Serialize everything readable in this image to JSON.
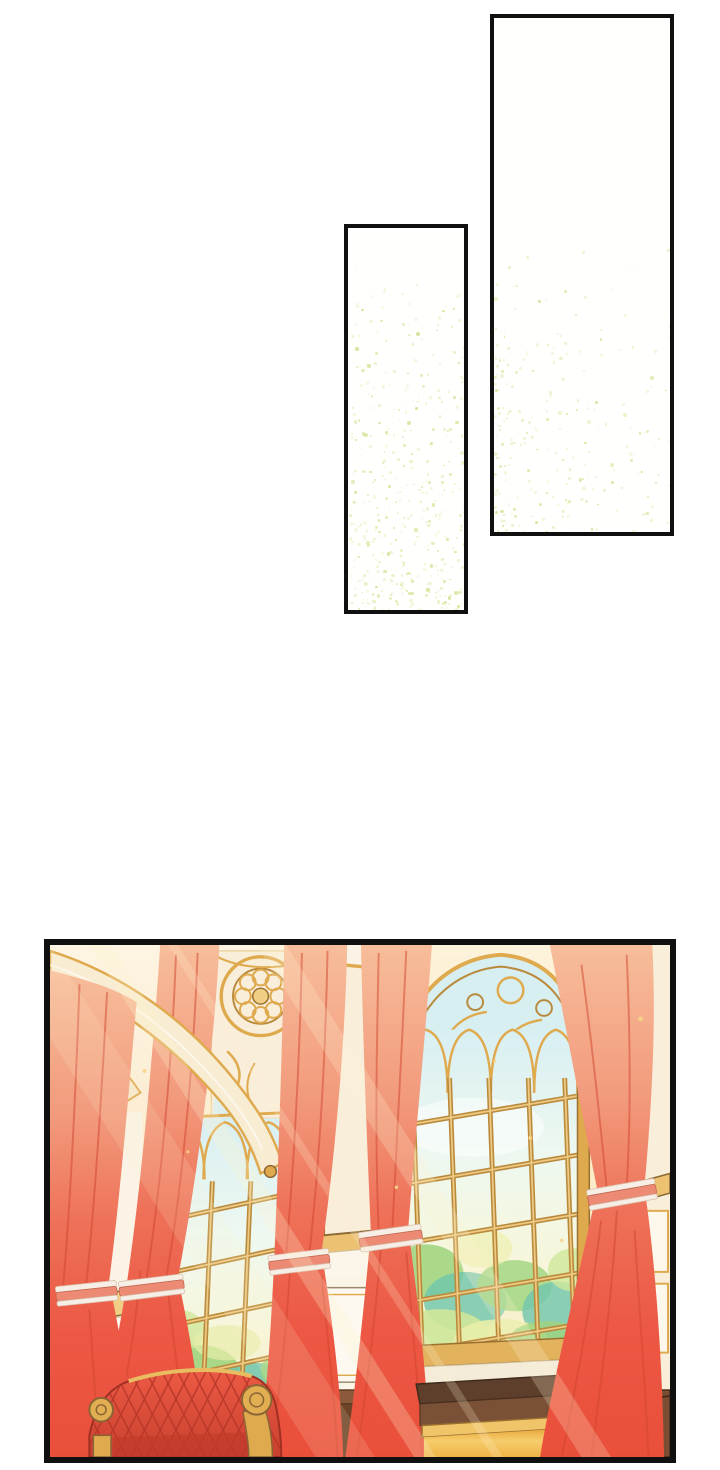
{
  "page": {
    "kind": "vertical webtoon episode page",
    "background": "#ffffff"
  },
  "colors": {
    "page_bg": "#ffffff",
    "panel_border": "#101010",
    "panel_bg": "#fffffe",
    "sparkle": "#d9e5a0",
    "sparkle_soft": "#ecf1ca",
    "cream": "#f9eeda",
    "cream_deep": "#f8e3c4",
    "white_warm": "#fbf4e6",
    "gold": "#dfa94e",
    "gold_light": "#f0cf84",
    "gold_dark": "#9a7030",
    "gold_line": "#b98a3c",
    "sky": "#d8eff2",
    "pane_ivory": "#f0eec6",
    "green": "#9ed47e",
    "green_deep": "#6fc6ad",
    "green_light": "#cfe79a",
    "curtain_top": "#f7bd9a",
    "curtain_mid": "#ee7158",
    "curtain_red": "#ea4f3a",
    "curtain_fold": "#d1452f",
    "ribbon_pink": "#ec8a74",
    "ribbon_white": "#f7eee6",
    "sofa_red": "#e4503c",
    "sofa_dark": "#b23427",
    "wood": "#5e3f2c",
    "wood_mid": "#8a5a3a",
    "amber": "#eda93f",
    "amber_light": "#f8d67a"
  },
  "panels": [
    {
      "label": "tall empty panel, gold dust drifting from lower left",
      "sparkles": {
        "seed": 11,
        "count": 240,
        "start": 0.4,
        "y_pow": 0.45,
        "x_pow": 1.7
      }
    },
    {
      "label": "narrow empty panel, dense gold dust rising from bottom",
      "sparkles": {
        "seed": 23,
        "count": 430,
        "start": 0.08,
        "y_pow": 0.5,
        "x_pow": 1.0
      }
    },
    {
      "label": "sunlit palace hall: gothic traceried windows, gold mullions, red tied-back curtains, red tufted sofa, amber side table"
    }
  ],
  "scene": {
    "elements": [
      "arch-ribs",
      "rose-window-tracery",
      "gothic-window-left",
      "gothic-window-right",
      "far-left-window",
      "marble-pillars",
      "curtain-1",
      "curtain-2",
      "curtain-3",
      "curtain-4",
      "curtain-5",
      "ribbon-ties",
      "tufted-sofa",
      "side-table",
      "wall-panels",
      "sunbeams",
      "gold-dust"
    ]
  }
}
